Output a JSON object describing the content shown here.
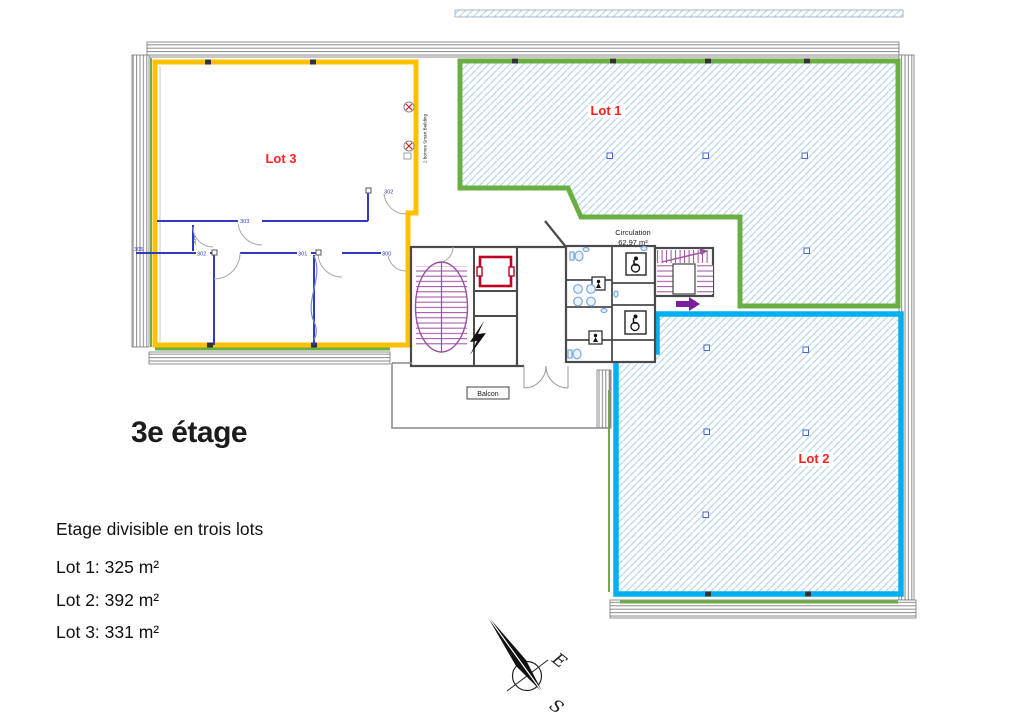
{
  "header": {
    "floor_title": "3e étage"
  },
  "legend": {
    "heading": "Etage divisible en trois lots",
    "lot1": "Lot 1: 325 m²",
    "lot2": "Lot 2: 392 m²",
    "lot3": "Lot 3: 331 m²"
  },
  "plan": {
    "lot1_label": "Lot 1",
    "lot2_label": "Lot 2",
    "lot3_label": "Lot 3",
    "circulation_name": "Circulation",
    "circulation_area": "62,97 m²",
    "balcony_label": "Balcon",
    "rooms": {
      "r300": "300",
      "r301": "301",
      "r302": "302",
      "r302_top": "302",
      "r303": "303",
      "r304": "304",
      "r305": "305"
    },
    "vertical_note": "2 bornes Smart Building",
    "colors": {
      "lot1_outline": "#6aaf44",
      "lot2_outline": "#00b0f0",
      "lot3_outline": "#ffc000",
      "lot_label": "#ff2020",
      "hatch": "#b9d6ec",
      "interior_walls_lot3": "#2f3bbf",
      "stairs": "#9b4f9e",
      "elevator": "#c00023"
    }
  },
  "compass": {
    "east_label": "E",
    "south_label": "S"
  }
}
